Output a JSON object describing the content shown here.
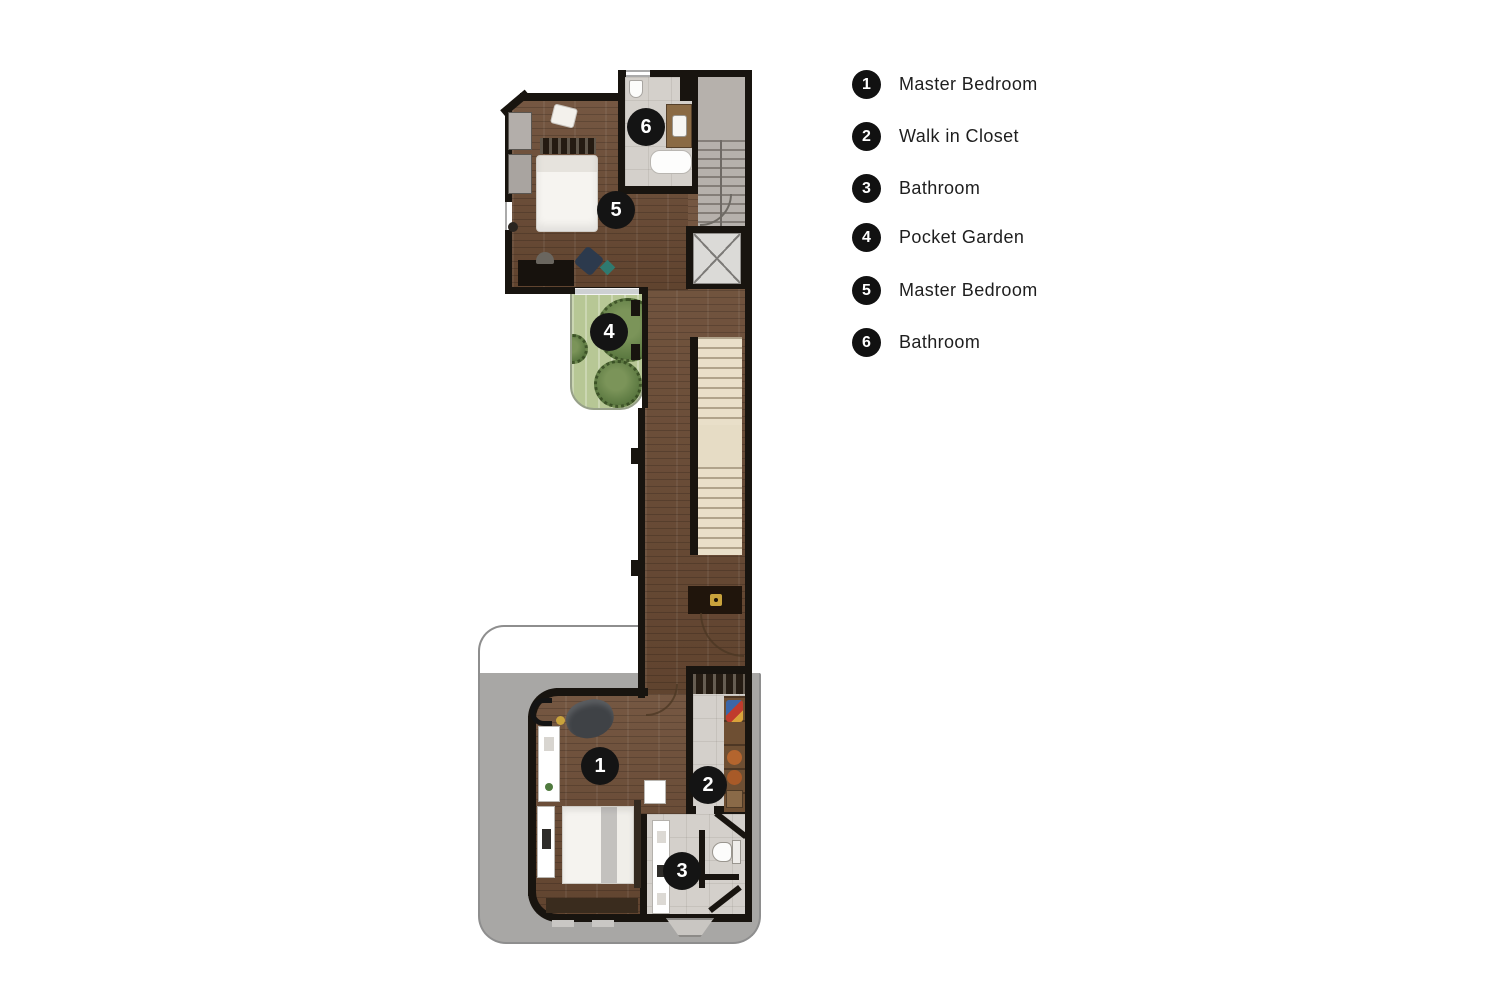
{
  "legend": {
    "items": [
      {
        "number": "1",
        "label": "Master Bedroom"
      },
      {
        "number": "2",
        "label": "Walk in Closet"
      },
      {
        "number": "3",
        "label": "Bathroom"
      },
      {
        "number": "4",
        "label": "Pocket Garden"
      },
      {
        "number": "5",
        "label": "Master Bedroom"
      },
      {
        "number": "6",
        "label": "Bathroom"
      }
    ]
  },
  "plan": {
    "markers": [
      {
        "number": "1",
        "room": "Master Bedroom"
      },
      {
        "number": "2",
        "room": "Walk in Closet"
      },
      {
        "number": "3",
        "room": "Bathroom"
      },
      {
        "number": "4",
        "room": "Pocket Garden"
      },
      {
        "number": "5",
        "room": "Master Bedroom"
      },
      {
        "number": "6",
        "room": "Bathroom"
      }
    ]
  },
  "colors": {
    "wall": "#18140f",
    "wood_floor": "#6b4b34",
    "tile_floor": "#d4d0cb",
    "stair_gray": "#b6b1ac",
    "step_beige": "#e9dfc9",
    "garden_green": "#b7c795",
    "tree_green": "#5d7a42",
    "terrace_gray": "#a8a7a5",
    "marker_black": "#141414",
    "gold_accent": "#c9a33c"
  }
}
